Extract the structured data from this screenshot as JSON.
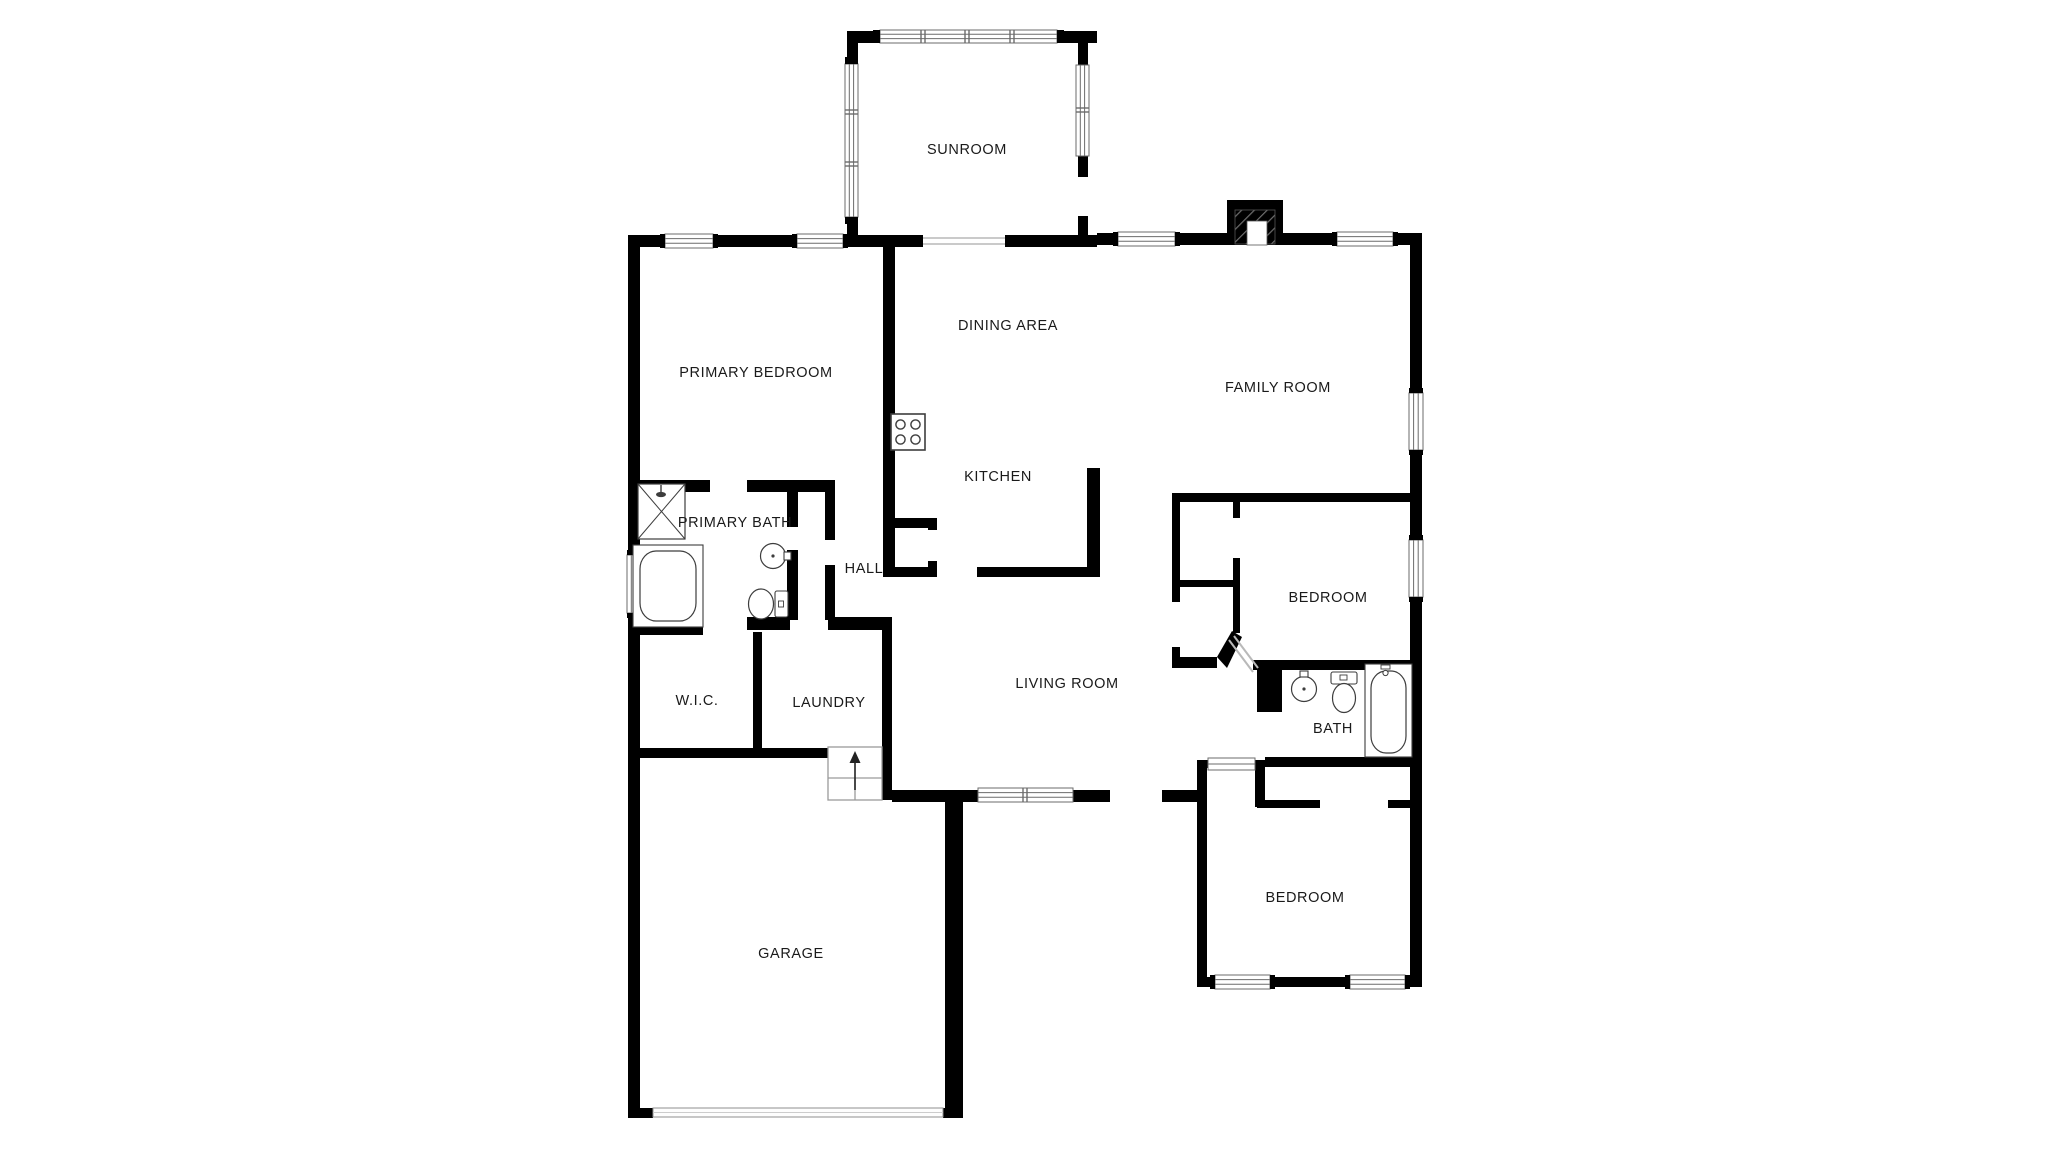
{
  "document": {
    "type": "residential-floor-plan",
    "background": "#ffffff"
  },
  "colors": {
    "wall": "#000000",
    "window_frame": "#6b6b6b",
    "window_fill": "#ffffff",
    "fixture_outline": "#3d3d3d",
    "opening_line": "#b9b9b9",
    "stairs_outline": "#9a9a9a",
    "hatch": "#6e6e6e",
    "label": "#1a1a1a"
  },
  "floor_plan": {
    "rooms": [
      {
        "name": "sunroom",
        "label": "SUNROOM"
      },
      {
        "name": "dining-area",
        "label": "DINING AREA"
      },
      {
        "name": "family-room",
        "label": "FAMILY ROOM"
      },
      {
        "name": "primary-bedroom",
        "label": "PRIMARY BEDROOM"
      },
      {
        "name": "kitchen",
        "label": "KITCHEN"
      },
      {
        "name": "primary-bath",
        "label": "PRIMARY BATH"
      },
      {
        "name": "hall",
        "label": "HALL"
      },
      {
        "name": "bedroom-middle",
        "label": "BEDROOM"
      },
      {
        "name": "living-room",
        "label": "LIVING ROOM"
      },
      {
        "name": "walk-in-closet",
        "label": "W.I.C."
      },
      {
        "name": "laundry",
        "label": "LAUNDRY"
      },
      {
        "name": "bath",
        "label": "BATH"
      },
      {
        "name": "bedroom-lower",
        "label": "BEDROOM"
      },
      {
        "name": "garage",
        "label": "GARAGE"
      }
    ],
    "fixtures": [
      "stove-icon",
      "shower-icon",
      "bathtub-icon",
      "sink-icon",
      "toilet-icon",
      "fireplace-icon",
      "stairs-up-icon",
      "garage-door"
    ],
    "stairs_direction": "up"
  }
}
